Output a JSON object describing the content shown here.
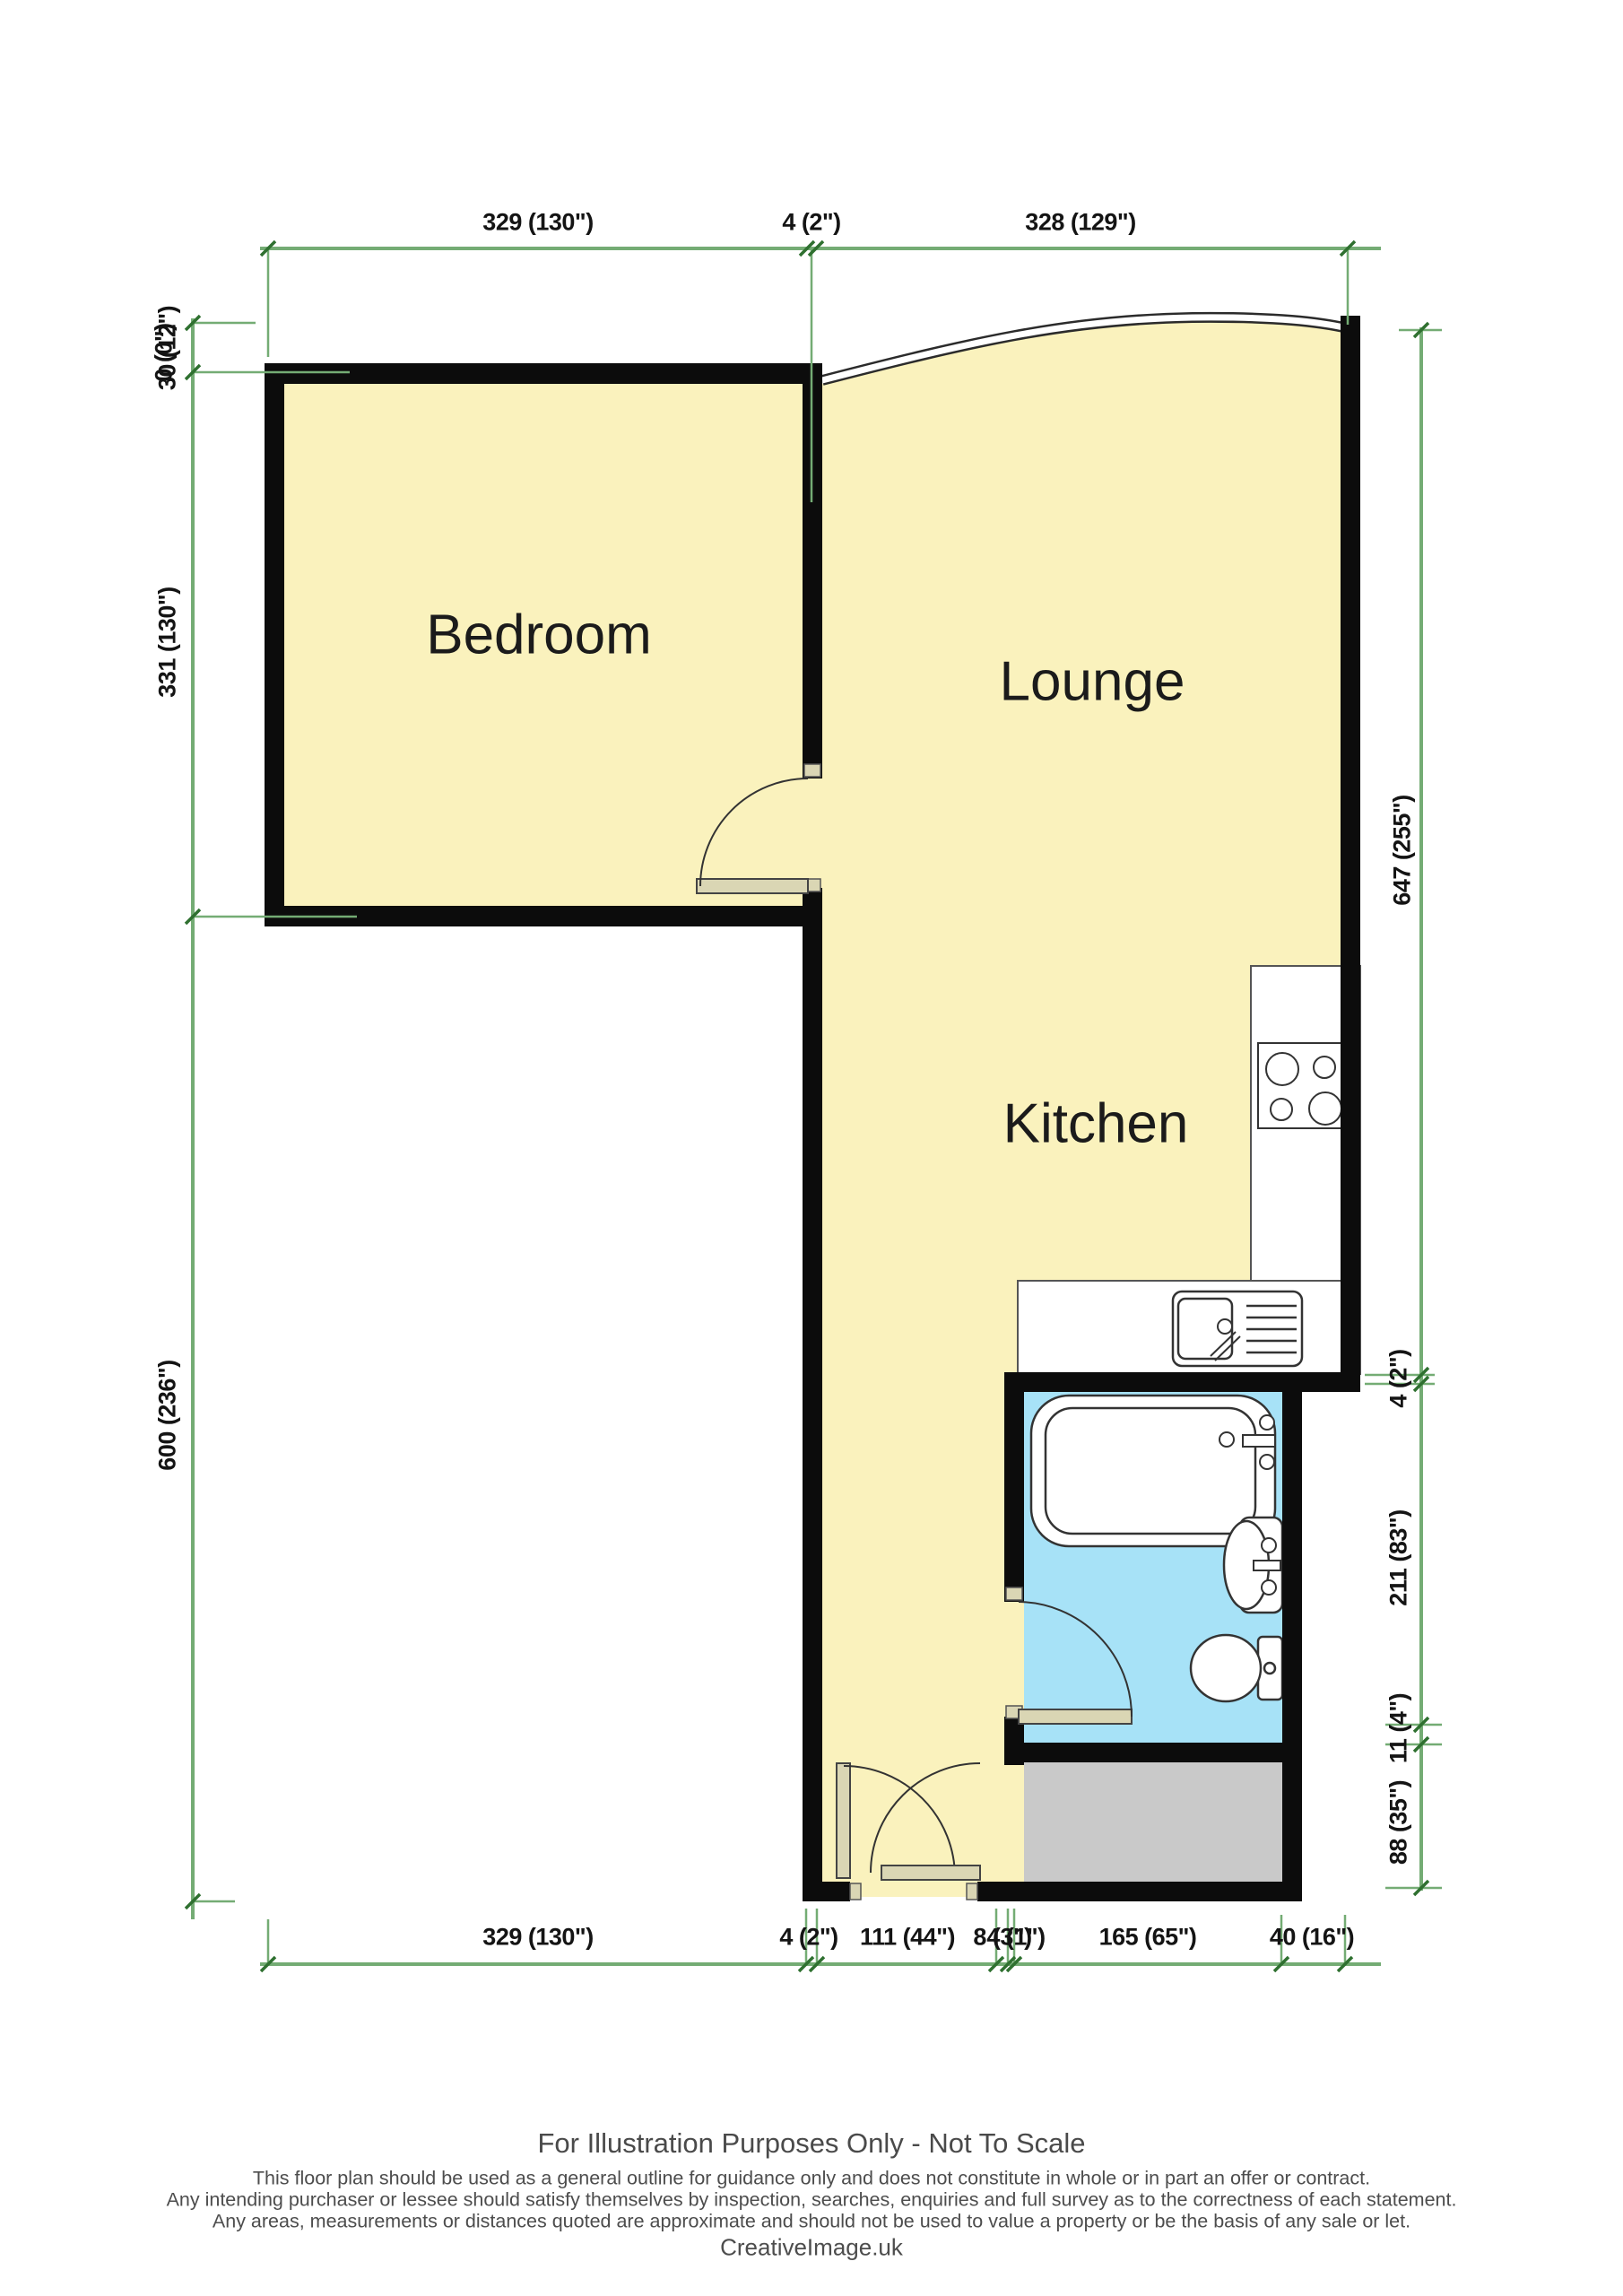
{
  "plan": {
    "rooms": {
      "bedroom": "Bedroom",
      "lounge": "Lounge",
      "kitchen": "Kitchen"
    },
    "colors": {
      "floor_yellow": "#FAF2BD",
      "bathroom_blue": "#A7E2F7",
      "hall_grey": "#C9C9C9",
      "dimension_green": "#74AC74",
      "wall_black": "#0c0c0c"
    },
    "fixtures": [
      "bathtub",
      "washbasin",
      "toilet",
      "hob",
      "kitchen-sink"
    ],
    "dims": {
      "top": [
        "329 (130\")",
        "4 (2\")",
        "328 (129\")"
      ],
      "bottom": [
        "329 (130\")",
        "4 (2\")",
        "111 (44\")",
        "8 (3\")",
        "4 (1\")",
        "165 (65\")",
        "40 (16\")"
      ],
      "left": [
        "30 (12\")",
        "0 (0\")",
        "331 (130\")",
        "600 (236\")"
      ],
      "right": [
        "647 (255\")",
        "4 (2\")",
        "211 (83\")",
        "11 (4\")",
        "88 (35\")"
      ]
    }
  },
  "footer": {
    "title": "For Illustration Purposes Only - Not To Scale",
    "lines": [
      "This floor plan should be used as a general outline for guidance only and does not constitute in whole or in part an offer or contract.",
      "Any intending purchaser or lessee should satisfy themselves by inspection, searches, enquiries and full survey as to the correctness of each statement.",
      "Any areas, measurements or distances quoted are approximate and should not be used to value a property or be the basis of any sale or let."
    ],
    "brand": "CreativeImage.uk"
  }
}
